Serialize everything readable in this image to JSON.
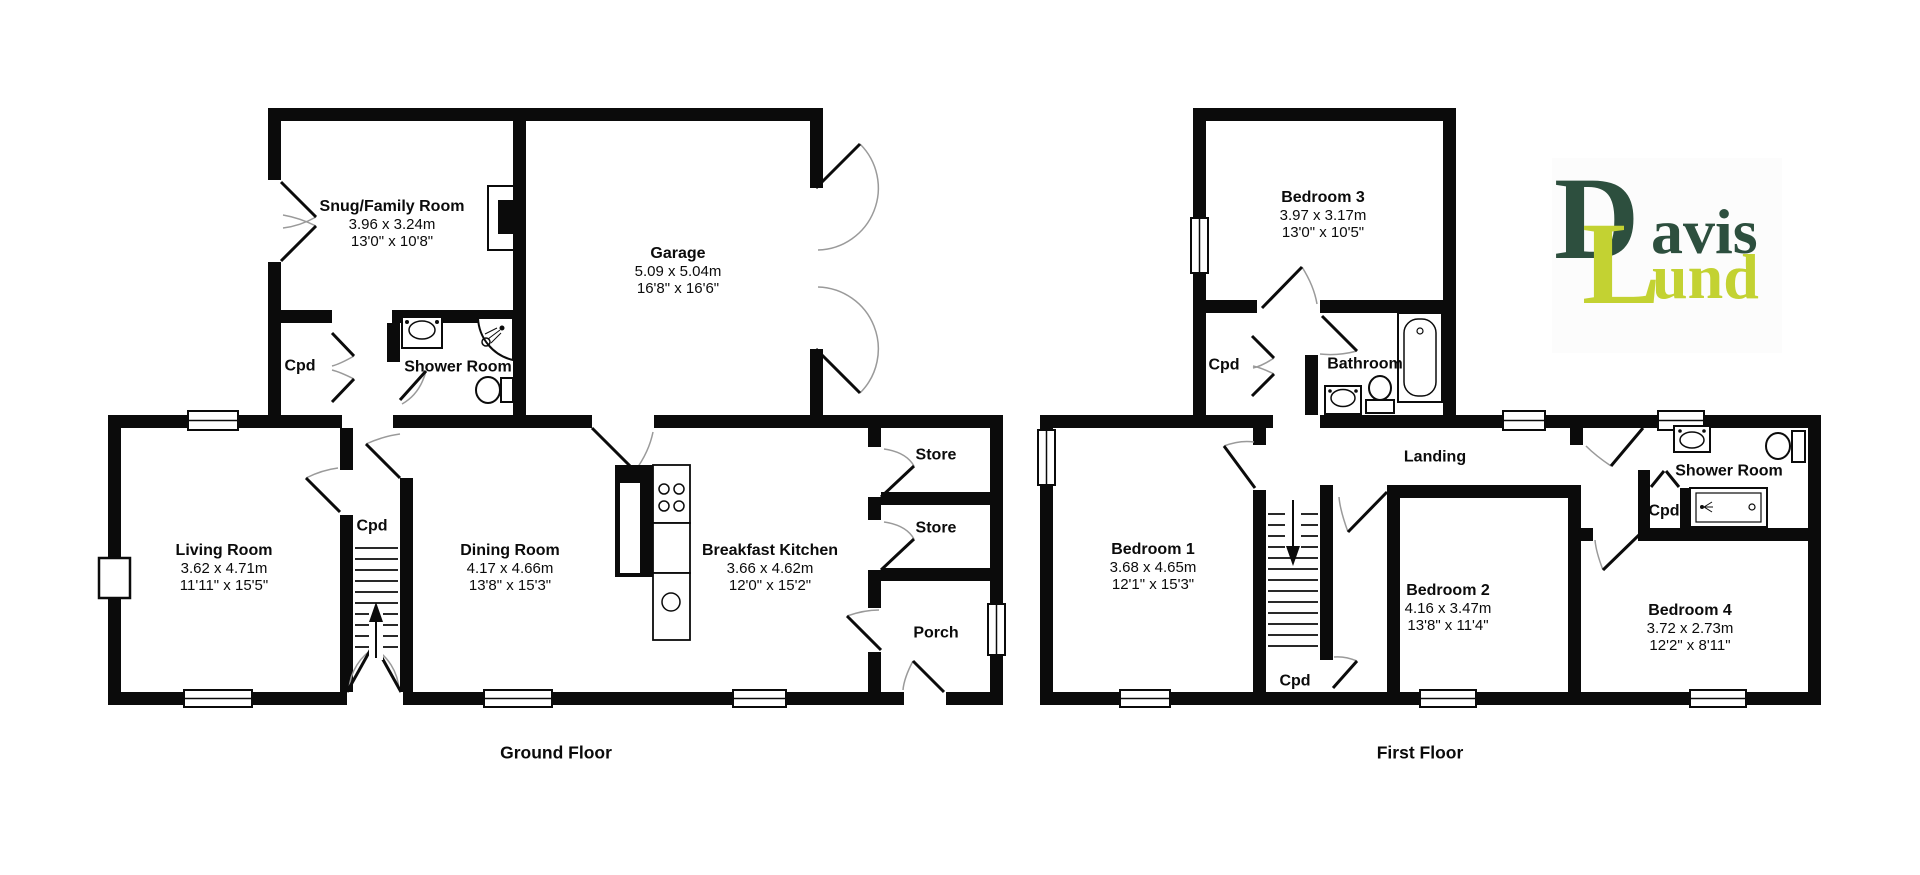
{
  "document": {
    "type": "floorplan",
    "background": "#ffffff",
    "wall_color": "#0b0b0b",
    "door_arc_color": "#9a9a9a"
  },
  "logo": {
    "initial_1": "D",
    "rest_1": "avis",
    "initial_2": "L",
    "rest_2": "und",
    "color_dark_green": "#2d4f3e",
    "color_yellow_green": "#c3d232"
  },
  "ground_floor": {
    "title": "Ground Floor",
    "rooms": {
      "snug": {
        "name": "Snug/Family Room",
        "size_m": "3.96 x 3.24m",
        "size_ft": "13'0\" x 10'8\""
      },
      "garage": {
        "name": "Garage",
        "size_m": "5.09 x 5.04m",
        "size_ft": "16'8\" x 16'6\""
      },
      "shower_room": {
        "name": "Shower Room"
      },
      "cpd_upper": {
        "name": "Cpd"
      },
      "living": {
        "name": "Living Room",
        "size_m": "3.62 x 4.71m",
        "size_ft": "11'11\" x 15'5\""
      },
      "cpd_hall": {
        "name": "Cpd"
      },
      "dining": {
        "name": "Dining Room",
        "size_m": "4.17 x 4.66m",
        "size_ft": "13'8\" x 15'3\""
      },
      "kitchen": {
        "name": "Breakfast Kitchen",
        "size_m": "3.66 x 4.62m",
        "size_ft": "12'0\" x 15'2\""
      },
      "store_1": {
        "name": "Store"
      },
      "store_2": {
        "name": "Store"
      },
      "porch": {
        "name": "Porch"
      }
    }
  },
  "first_floor": {
    "title": "First Floor",
    "rooms": {
      "bedroom_3": {
        "name": "Bedroom 3",
        "size_m": "3.97 x 3.17m",
        "size_ft": "13'0\" x 10'5\""
      },
      "cpd_landing": {
        "name": "Cpd"
      },
      "bathroom": {
        "name": "Bathroom"
      },
      "bedroom_1": {
        "name": "Bedroom 1",
        "size_m": "3.68 x 4.65m",
        "size_ft": "12'1\" x 15'3\""
      },
      "landing": {
        "name": "Landing"
      },
      "shower_room": {
        "name": "Shower Room"
      },
      "cpd_shower": {
        "name": "Cpd"
      },
      "bedroom_2": {
        "name": "Bedroom 2",
        "size_m": "4.16 x 3.47m",
        "size_ft": "13'8\" x 11'4\""
      },
      "bedroom_4": {
        "name": "Bedroom 4",
        "size_m": "3.72 x 2.73m",
        "size_ft": "12'2\" x 8'11\""
      },
      "cpd_understairs": {
        "name": "Cpd"
      }
    }
  }
}
